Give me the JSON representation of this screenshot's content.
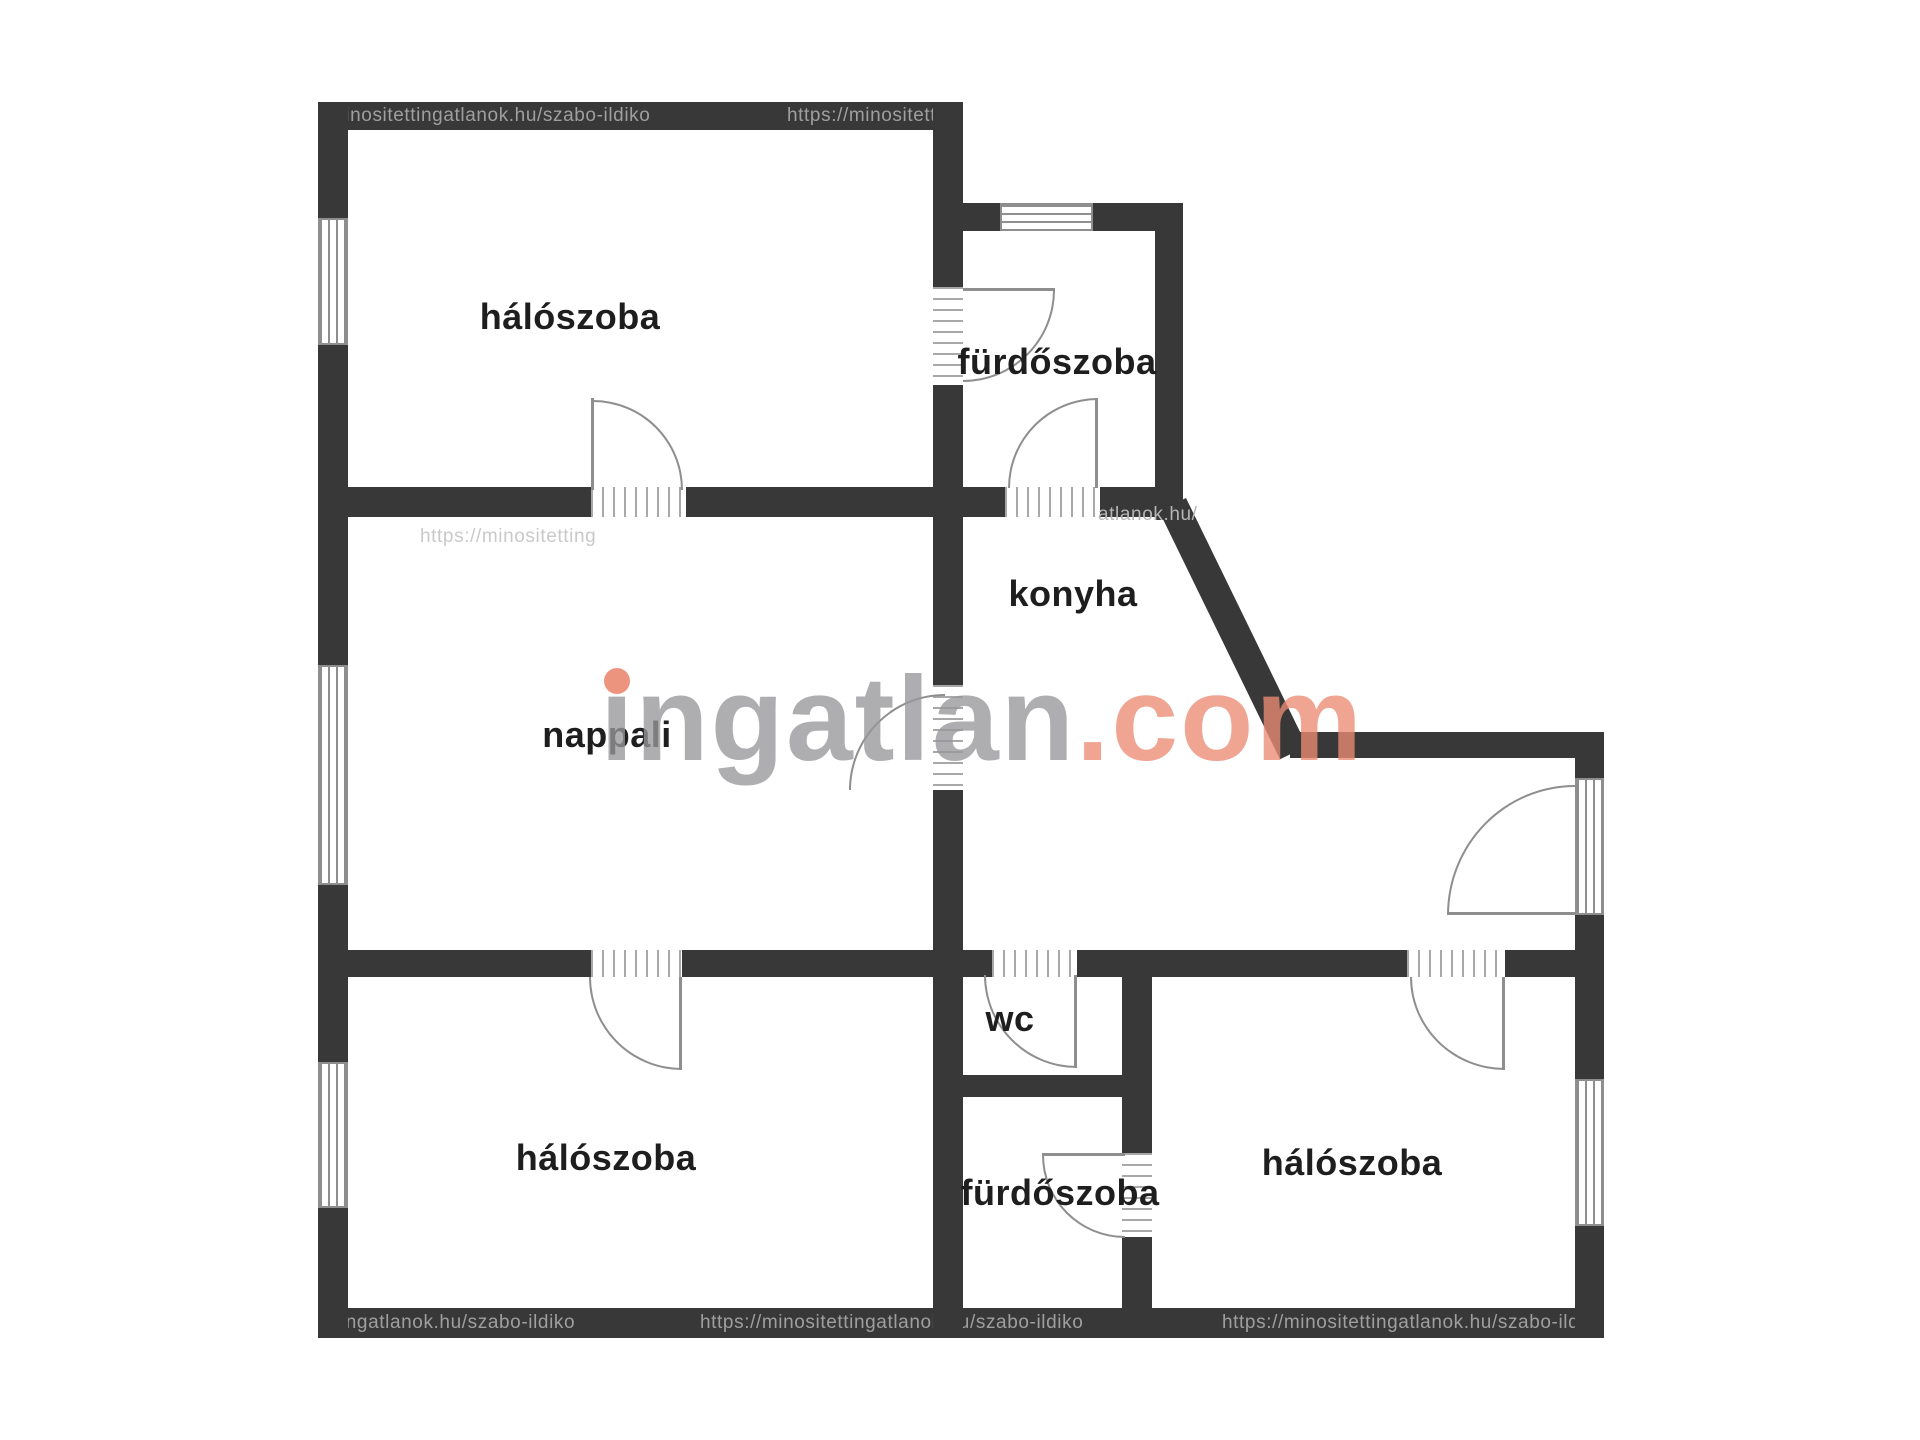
{
  "floor_plan": {
    "type": "apartment-floor-plan",
    "rooms": [
      {
        "id": "bedroom-top-left",
        "label": "hálószoba"
      },
      {
        "id": "bathroom-top",
        "label": "fürdőszoba"
      },
      {
        "id": "kitchen",
        "label": "konyha"
      },
      {
        "id": "living-room",
        "label": "nappali"
      },
      {
        "id": "wc",
        "label": "wc"
      },
      {
        "id": "bedroom-bottom-left",
        "label": "hálószoba"
      },
      {
        "id": "bathroom-bottom",
        "label": "fürdőszoba"
      },
      {
        "id": "bedroom-bottom-right",
        "label": "hálószoba"
      }
    ]
  },
  "watermarks": {
    "brand_name": "ingatlan",
    "brand_tld": ".com",
    "url_top_left": "/minositettingatlanok.hu/szabo-ildiko",
    "url_top_right": "https://minositettingat",
    "url_mid_left": "https://minositetting",
    "url_mid_right": "atlanok.hu/",
    "url_bottom_1": "ettingatlanok.hu/szabo-ildiko",
    "url_bottom_2": "https://minositettingatlanok.hu/szabo-ildiko",
    "url_bottom_3": "https://minositettingatlanok.hu/szabo-ildiko"
  },
  "colors": {
    "wall": "#383838",
    "background": "#ffffff",
    "label_text": "#1e1e1e",
    "symbol_stroke": "#8e8e8e",
    "brand_gray": "#98989b",
    "brand_accent": "#ec8b74",
    "watermark_on_wall": "#9f9f9f",
    "watermark_on_white": "#c9c9c9"
  }
}
